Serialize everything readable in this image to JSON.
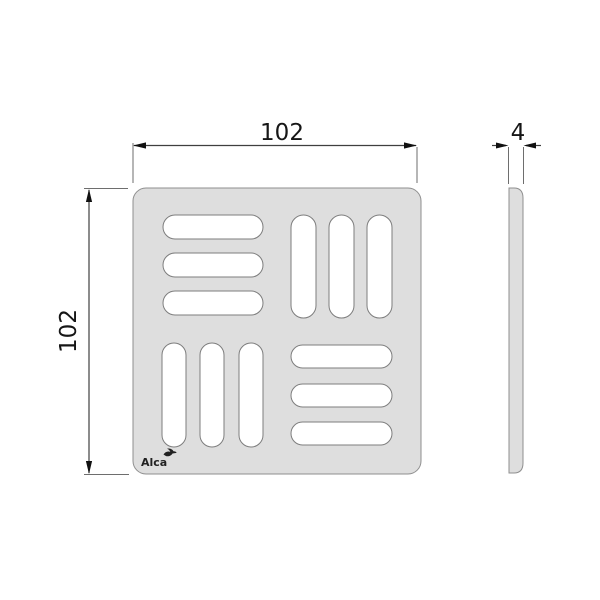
{
  "dimensions": {
    "top_width": "102",
    "left_height": "102",
    "side_thickness": "4"
  },
  "logo": {
    "text": "Alca"
  },
  "colors": {
    "background": "#ffffff",
    "body_fill": "#dedede",
    "body_stroke": "#8f8f8f",
    "slot_fill": "#ffffff",
    "slot_stroke": "#7d7d7d",
    "dimension_line": "#3f3f3f",
    "extension_line": "#6e6e6e",
    "arrow": "#111111",
    "text": "#161616"
  }
}
